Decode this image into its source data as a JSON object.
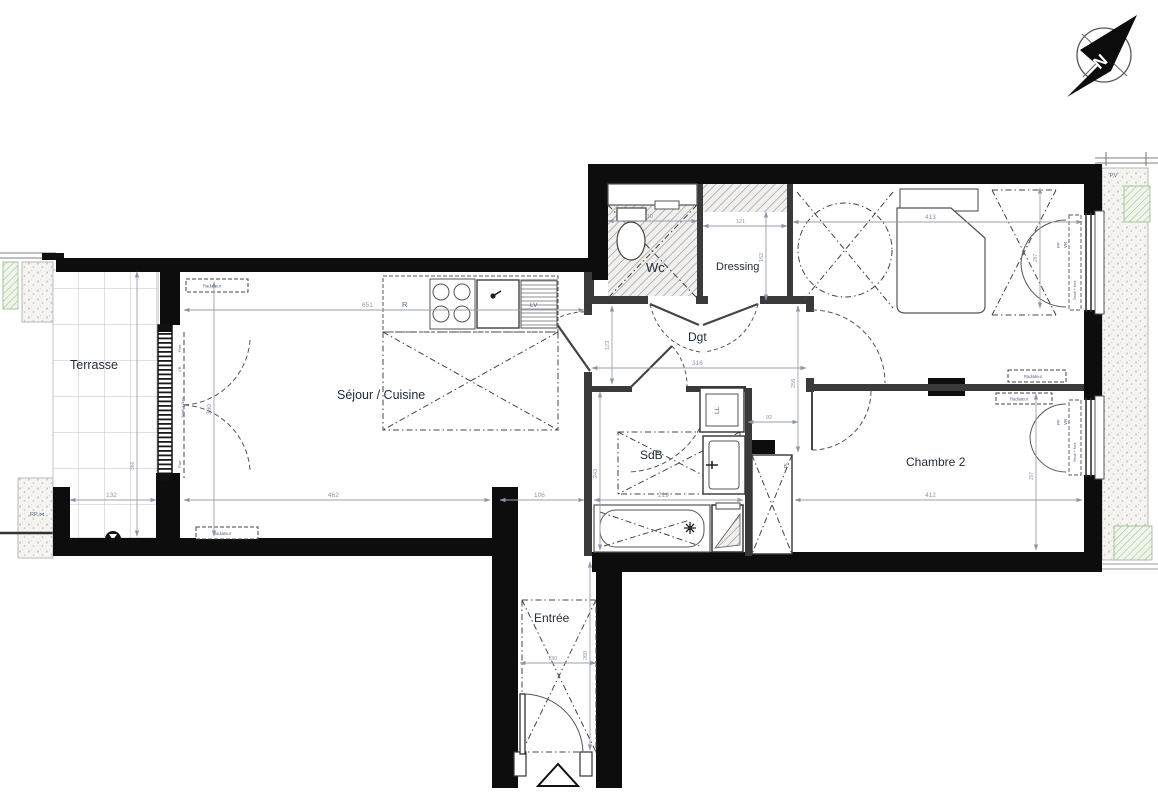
{
  "plan_title": "Apartment floor plan (2-bedroom, T3)",
  "compass": {
    "north_label": "N"
  },
  "rooms": {
    "terrasse": {
      "label": "Terrasse"
    },
    "sejour": {
      "label": "Séjour / Cuisine"
    },
    "wc": {
      "label": "Wc"
    },
    "dressing": {
      "label": "Dressing"
    },
    "chambre1": {
      "label": "Chambre 1"
    },
    "dgt": {
      "label": "Dgt"
    },
    "sdb": {
      "label": "SdB"
    },
    "chambre2": {
      "label": "Chambre 2"
    },
    "entree": {
      "label": "Entrée"
    }
  },
  "annotations": {
    "radiator": "Radiateur",
    "fridge": "R",
    "dishwasher": "LV",
    "washer": "LL",
    "closet": "Pl.",
    "pv": "PV",
    "rp": "RP ⋈",
    "pf": "PF",
    "vr": "VR",
    "fixed": "Fixe",
    "threshold": "Seuil + Nez"
  },
  "dimensions": {
    "sejour_w": "651",
    "sejour_h": "360",
    "terrasse_w": "132",
    "terrasse_h": "366",
    "sejour_bottom": "462",
    "passage": "106",
    "wc_w": "110",
    "dressing_w": "121",
    "dressing_h": "162",
    "chambre1_w": "413",
    "chambre1_win": "287",
    "dgt_w": "316",
    "dgt_h_left": "123",
    "dgt_h_right": "256",
    "ll_offset": "92",
    "sdb_w": "219",
    "sdb_h": "243",
    "chambre2_w": "412",
    "chambre2_win": "207",
    "entree_w": "130",
    "entree_h": "260"
  },
  "colors": {
    "wall": "#0d0d0d",
    "partition": "#3a3a3a",
    "dim_text": "#8d96aa",
    "label_text": "#232c3a",
    "fixture_text": "#54648c",
    "green_hatch": "#a3c493"
  }
}
